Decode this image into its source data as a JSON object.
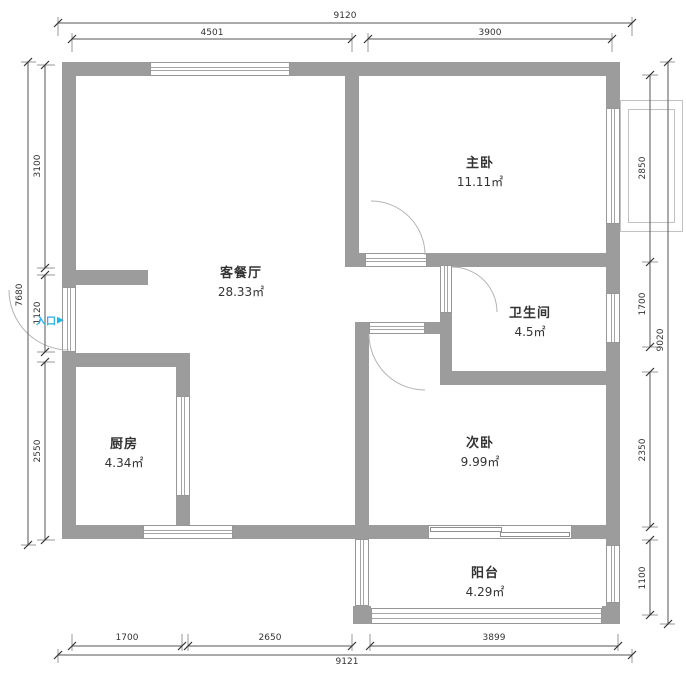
{
  "colors": {
    "wall_gray": "#9c9c9c",
    "accent_cyan": "#2bb3e0",
    "line_dark": "#444444"
  },
  "rooms": {
    "living": {
      "name": "客餐厅",
      "area": "28.33㎡"
    },
    "master": {
      "name": "主卧",
      "area": "11.11㎡"
    },
    "bathroom": {
      "name": "卫生间",
      "area": "4.5㎡"
    },
    "kitchen": {
      "name": "厨房",
      "area": "4.34㎡"
    },
    "second": {
      "name": "次卧",
      "area": "9.99㎡"
    },
    "balcony": {
      "name": "阳台",
      "area": "4.29㎡"
    }
  },
  "entrance": {
    "label": "入口",
    "arrow": "▶"
  },
  "dimensions": {
    "top": {
      "total": "9120",
      "left": "4501",
      "right": "3900"
    },
    "left": {
      "total": "7680",
      "upper": "3100",
      "entrance": "1120",
      "lower": "2550"
    },
    "right": {
      "total": "9020",
      "master": "2850",
      "bathroom": "1700",
      "second": "2350",
      "balcony": "1100"
    },
    "bottom": {
      "total": "9121",
      "kitchen": "1700",
      "living": "2650",
      "balcony": "3899"
    }
  }
}
